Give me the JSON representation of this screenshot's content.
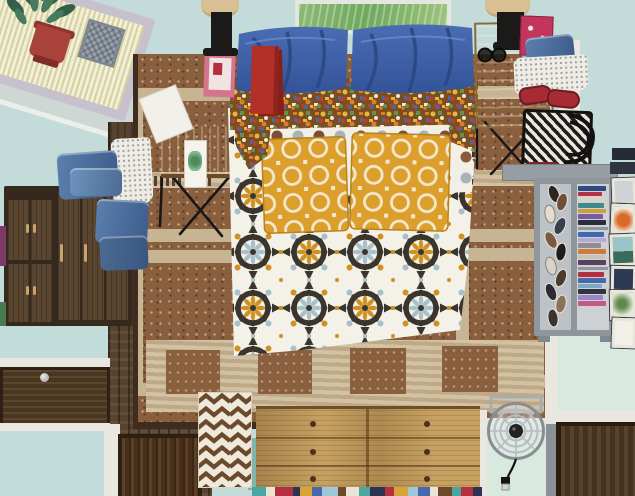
{
  "artwork": {
    "title": "Overhead bedroom interior painting",
    "medium": "flat decorative painting, bird's-eye view of a bedroom"
  },
  "palette": {
    "wall": "#c4dcd9",
    "mint": "#d8e9e0",
    "panelBlue": "#c2dcda",
    "trimWhite": "#e9e7df",
    "matCream": "#f2efd9",
    "matBorder": "#c7c1cd",
    "bandBlue": "#cdd8d4",
    "plantGreen": "#34604b",
    "potRed": "#a8423a",
    "basketGray": "#9aa3ab",
    "paintGreen": "#7fb269",
    "frameLight": "#e4e7df",
    "woodDark": "#56422f",
    "rugBrown": "#8a5f3e",
    "rugLight": "#c9b897",
    "wardrobe": "#35281c",
    "wardrobeDoor": "#5a4530",
    "handleTan": "#c9a36a",
    "oak": "#c7a162",
    "doorWood": "#4a3322",
    "quiltWhite": "#f4f1e8",
    "medallionDark": "#3a362e",
    "medallionBlue": "#a9c0c9",
    "medallionGold": "#d09123",
    "pillowBlue": "#3f62a8",
    "pillowBlueDark": "#2a4682",
    "mustard": "#dd9f2b",
    "confettiOrange": "#dd7f2a",
    "confettiGold": "#e5b83d",
    "confettiGreen": "#5d9650",
    "polkaBrown": "#7c4e33",
    "polkaGray": "#a9b2b8",
    "polkaBlack": "#2e2b27",
    "denim": "#5b7fae",
    "slipperRed": "#a62b35",
    "bagBlack": "#201e1c",
    "shelfGray": "#8f969c",
    "chevronBrown": "#6b4a2c",
    "tealMat": "#7fb5ae",
    "lampBlack": "#1c1a19",
    "lampShade": "#d9c094",
    "bookPink": "#d4758d",
    "bookRed": "#b23028",
    "magentaMagazine": "#c2355c",
    "fanGray": "#b7bcc0",
    "fanHub": "#23211f"
  },
  "objects": {
    "room": "Bedroom seen from directly above",
    "nook": "Corner window nook with striped mat, potted plant and woven basket",
    "painting": "Green landscape painting on wall above bed",
    "bed": "Bed with white medallion-pattern quilt, mustard pillows and blue pillows with floral trim",
    "rug": "Brown speckled area rug with light square motifs",
    "wardrobe": "Dark walnut wardrobe with paneled doors",
    "clothesLeft": "Folded denim and dotted cloth on wardrobe",
    "leftNightstand": "Nightstand with books, card and black lamp",
    "rightNightstand": "Nightstand with lamp, magazine and sunglasses",
    "clothesRight": "Pile with denim, dotted cloth, red slippers and patterned bag",
    "bookshelf": "Gray shelf unit holding shoes and stacked books",
    "frames": "Framed pictures leaning against the wall",
    "chevronRug": "Brown and white chevron runner",
    "dresser": "Light oak six-drawer dresser",
    "fan": "Caged fan with cord",
    "doorBottomLeft": "Dark wood doors and blue panels at bottom left",
    "doorBottomRight": "Dark wood door at bottom right"
  }
}
